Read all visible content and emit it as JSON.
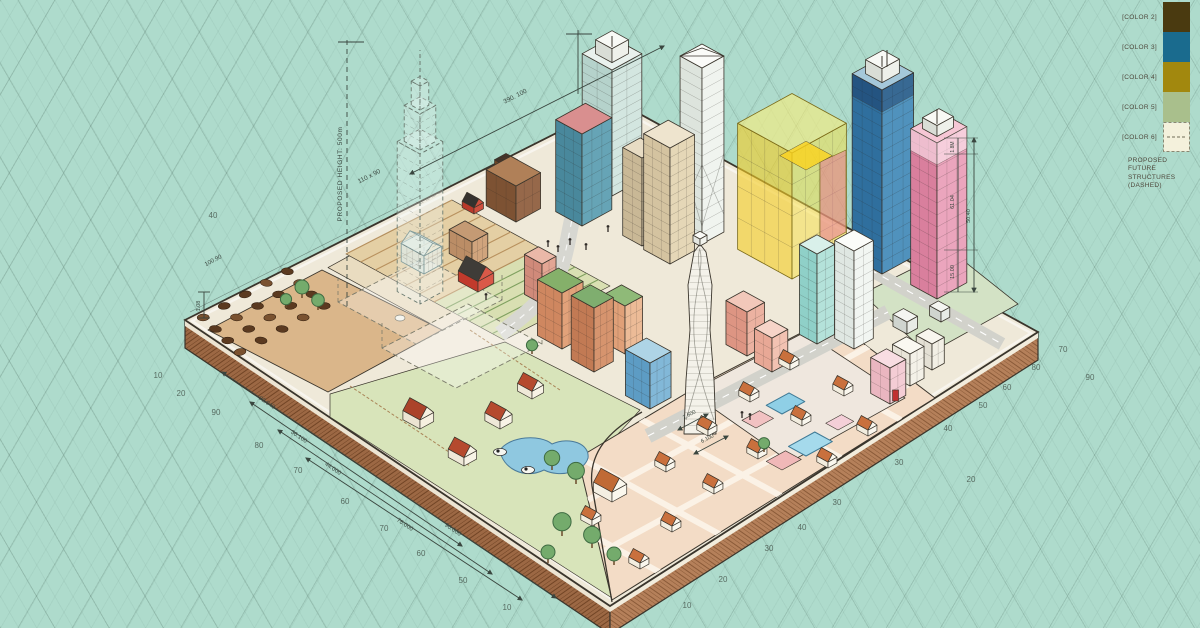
{
  "canvas": {
    "width": 1200,
    "height": 628,
    "background_color": "#aedbcc",
    "grid_line_color": "#46645a"
  },
  "legend": {
    "items": [
      {
        "label": "[COLOR 2]",
        "color": "#4a3a10",
        "dashed": false
      },
      {
        "label": "[COLOR 3]",
        "color": "#1a6b8e",
        "dashed": false
      },
      {
        "label": "[COLOR 4]",
        "color": "#a2880e",
        "dashed": false
      },
      {
        "label": "[COLOR 5]",
        "color": "#a9bf8c",
        "dashed": false
      },
      {
        "label": "[COLOR 6]",
        "color": "#f4f1dc",
        "dashed": true
      }
    ],
    "note": "PROPOSED FUTURE STRUCTURES (DASHED)"
  },
  "dims": {
    "height_label": "PROPOSED HEIGHT: 500m",
    "top": "390. 100",
    "nw_a": "110 x 90",
    "nw_b": "100.90",
    "corner": "1.08",
    "sw": [
      "92.040",
      "36.100",
      "44.000",
      "78.000",
      "90.000"
    ],
    "right": [
      "1.8M",
      "61.04",
      "50.40",
      "15.00"
    ],
    "center": [
      "2.600",
      "6.100"
    ]
  },
  "grid_numbers": [
    {
      "x": 158,
      "y": 378,
      "v": "10"
    },
    {
      "x": 181,
      "y": 396,
      "v": "20"
    },
    {
      "x": 216,
      "y": 415,
      "v": "90"
    },
    {
      "x": 213,
      "y": 218,
      "v": "40"
    },
    {
      "x": 259,
      "y": 448,
      "v": "80"
    },
    {
      "x": 298,
      "y": 473,
      "v": "70"
    },
    {
      "x": 345,
      "y": 504,
      "v": "60"
    },
    {
      "x": 384,
      "y": 531,
      "v": "70"
    },
    {
      "x": 421,
      "y": 556,
      "v": "60"
    },
    {
      "x": 463,
      "y": 583,
      "v": "50"
    },
    {
      "x": 507,
      "y": 610,
      "v": "10"
    },
    {
      "x": 687,
      "y": 608,
      "v": "10"
    },
    {
      "x": 723,
      "y": 582,
      "v": "20"
    },
    {
      "x": 769,
      "y": 551,
      "v": "30"
    },
    {
      "x": 802,
      "y": 530,
      "v": "40"
    },
    {
      "x": 837,
      "y": 505,
      "v": "30"
    },
    {
      "x": 899,
      "y": 465,
      "v": "30"
    },
    {
      "x": 971,
      "y": 482,
      "v": "20"
    },
    {
      "x": 948,
      "y": 431,
      "v": "40"
    },
    {
      "x": 983,
      "y": 408,
      "v": "50"
    },
    {
      "x": 1007,
      "y": 390,
      "v": "60"
    },
    {
      "x": 1036,
      "y": 370,
      "v": "80"
    },
    {
      "x": 1063,
      "y": 352,
      "v": "70"
    },
    {
      "x": 1090,
      "y": 380,
      "v": "90"
    }
  ],
  "palette": {
    "plot_surface": "#efe9d9",
    "brick_wall": "#a4704c",
    "farm_dirt": "#dab68a",
    "pasture": "#d8e4ba",
    "suburb_ground": "#f3dcc6",
    "road": "#d2d2cb",
    "glass_cube_yellow": "#f3cd26",
    "tower_blue": "#2f6f9e",
    "tower_pink": "#e080a0",
    "barn_red": "#c13a2c",
    "roof_orange": "#c9703d",
    "pond_blue": "#8fc8e0",
    "annotation_ink": "#3a463f"
  }
}
